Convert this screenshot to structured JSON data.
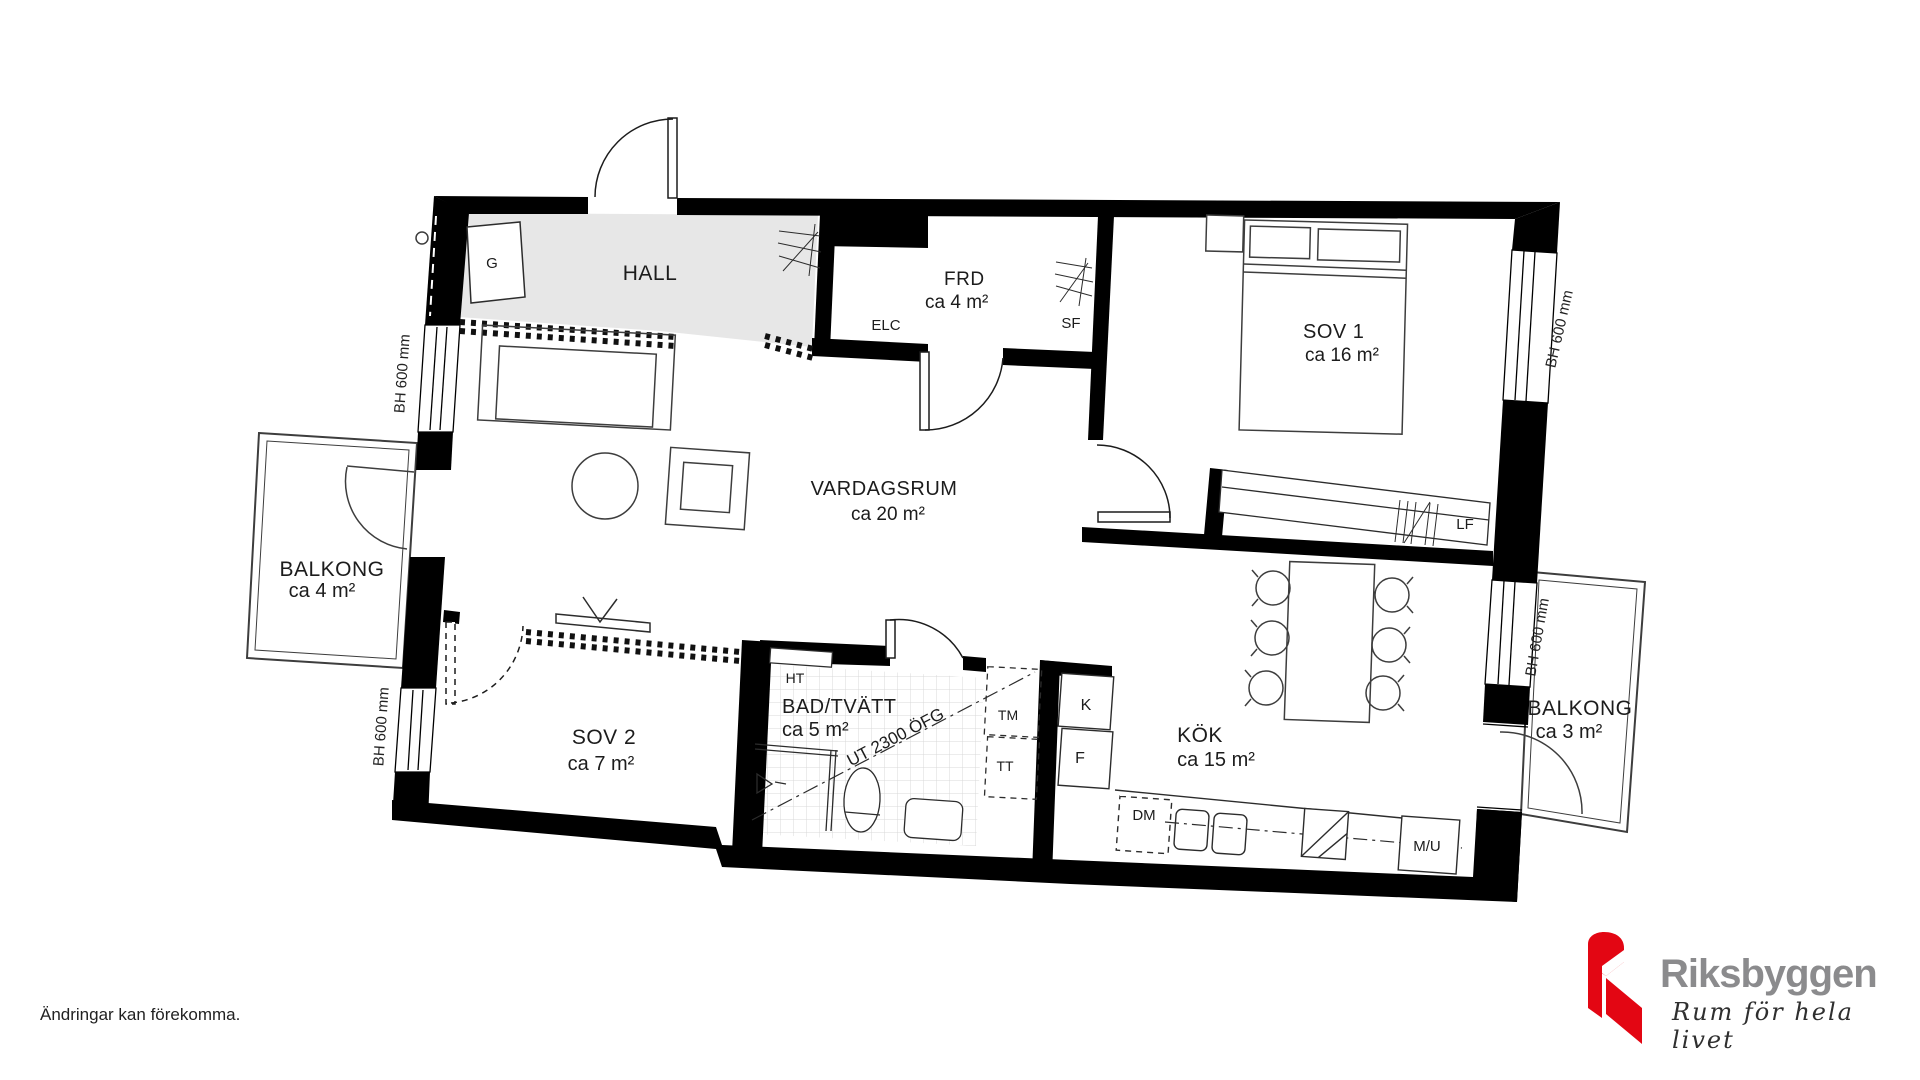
{
  "rooms": {
    "hall": {
      "label": "HALL"
    },
    "frd": {
      "label": "FRD",
      "area": "ca 4 m²"
    },
    "sov1": {
      "label": "SOV 1",
      "area": "ca 16 m²"
    },
    "vardagsrum": {
      "label": "VARDAGSRUM",
      "area": "ca 20 m²"
    },
    "balkong_left": {
      "label": "BALKONG",
      "area": "ca 4 m²"
    },
    "sov2": {
      "label": "SOV 2",
      "area": "ca 7 m²"
    },
    "bad": {
      "label": "BAD/TVÄTT",
      "area": "ca 5 m²"
    },
    "kok": {
      "label": "KÖK",
      "area": "ca 15 m²"
    },
    "balkong_right": {
      "label": "BALKONG",
      "area": "ca 3 m²"
    }
  },
  "fixtures": {
    "g": "G",
    "elc": "ELC",
    "sf": "SF",
    "lf": "LF",
    "ht": "HT",
    "tm": "TM",
    "tt": "TT",
    "k": "K",
    "f": "F",
    "dm": "DM",
    "mu": "M/U"
  },
  "annotations": {
    "window_height": "BH 600 mm",
    "door_height": "UT 2300 ÖFG"
  },
  "footer": {
    "disclaimer": "Ändringar kan förekomma."
  },
  "brand": {
    "name": "Riksbyggen",
    "tagline": "Rum för hela livet",
    "red": "#e30613",
    "text_gray": "#8b8b8d"
  }
}
